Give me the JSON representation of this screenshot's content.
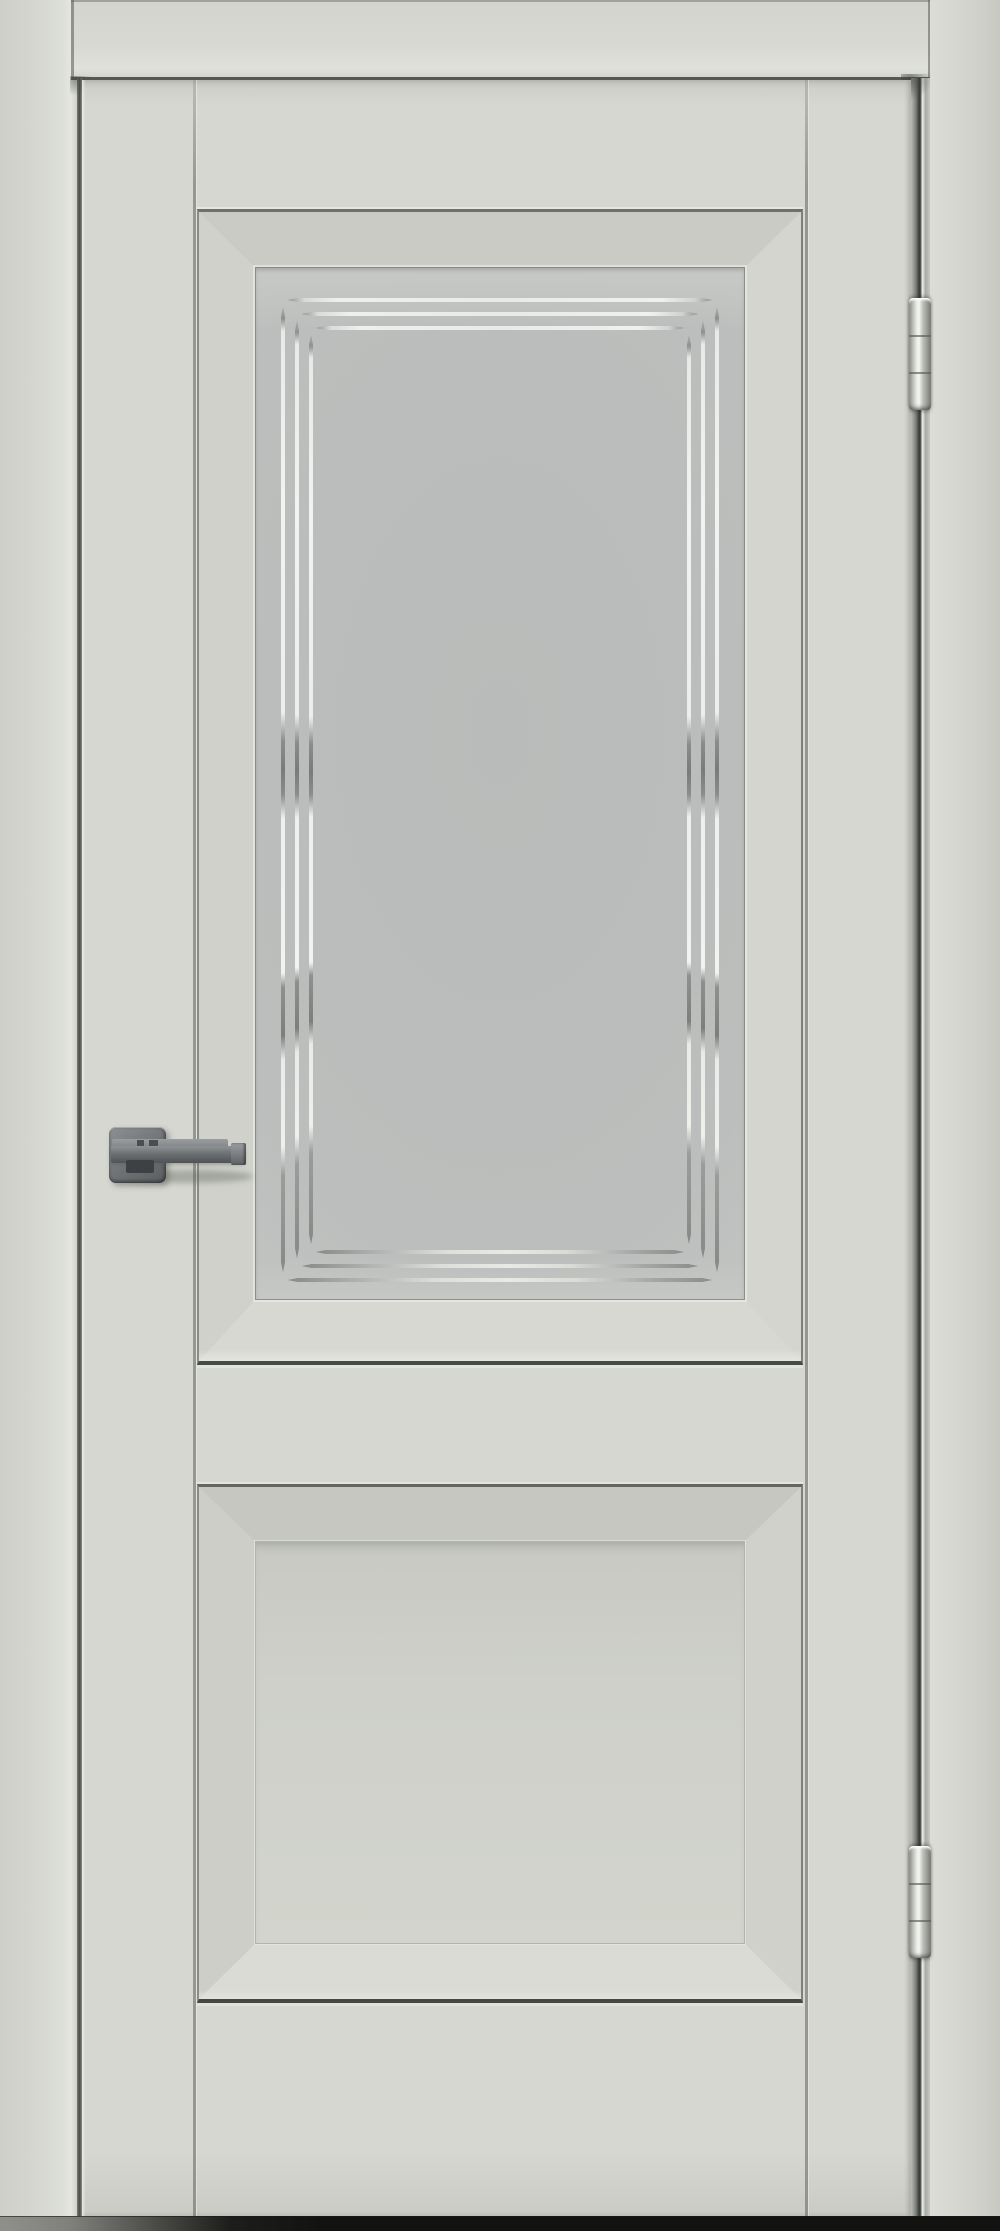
{
  "scene": {
    "description": "Front view product photo of a closed interior door in a light grey enamel finish, set in a matching frame. Two-panel door: upper panel glazed with frosted glass decorated by three nested etched chrome lines with staggered pointed corners; lower panel is a solid raised panel. Graphite square-rosette lever handle on the left stile, two chrome hinges on the right edge, dark floor shadow under the door."
  },
  "door": {
    "finish": "light grey matte enamel",
    "panel_count": 2,
    "upper_panel": {
      "type": "glazed",
      "glass": "frosted satin glass",
      "pattern": "three nested rectangular etched grooves with staggered pointed ends at corners",
      "groove_rings": 3
    },
    "lower_panel": {
      "type": "solid recessed panel with beveled moulding"
    },
    "hardware": {
      "handle": "square rosette lever, graphite / gunmetal, pointing right",
      "hinge_count": 2,
      "hinge_finish": "polished chrome"
    }
  },
  "colors": {
    "door-face": "#d5d7d0",
    "casing-face": "#d4d6cf",
    "jamb-face": "#d6d8d1",
    "gap-dark": "#4a4d47",
    "edge-dark": "#45483f",
    "bevel-light": "#d6d8d1",
    "bevel-shadow": "#c9cbc4",
    "glass-frost": "#b9bbba",
    "glass-edge": "#cdcfcc",
    "groove-bright": "#f0f1ef",
    "groove-dark": "#868986",
    "chrome-bright": "#eff1ed",
    "chrome-dark": "#31342f",
    "handle-metal": "#6e7275",
    "handle-dark": "#4a4e51",
    "shadow-floor": "#121210"
  }
}
